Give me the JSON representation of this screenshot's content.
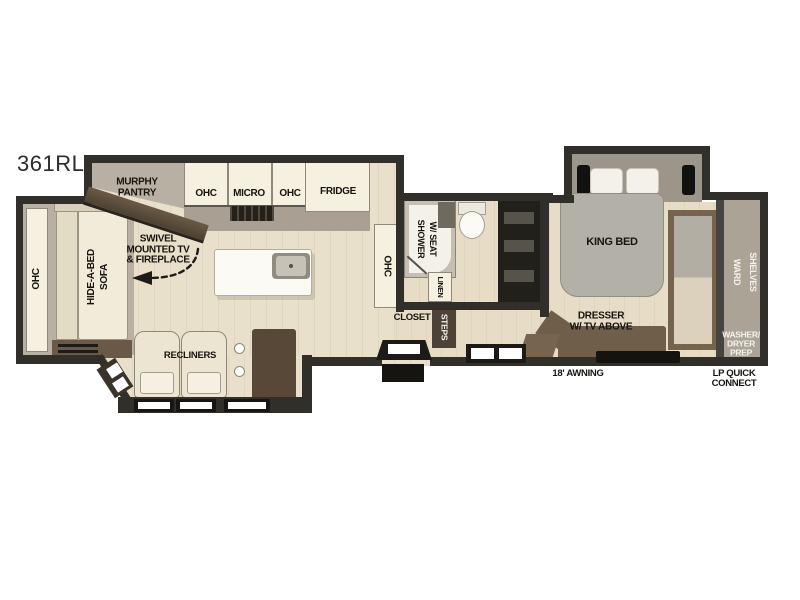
{
  "model": "361RL",
  "palette": {
    "wall": "#312f2a",
    "floor_main": "#e9e0cb",
    "floor_bed_bath": "#e7dcc5",
    "slide_floor": "#b8b0a2",
    "closet_floor": "#aba395",
    "cabinet_white": "#f6f0e0",
    "counter_gray": "#a9a093",
    "furniture_brown": "#6f5e4a",
    "dark_brown": "#4c4336",
    "sofa_cream": "#f1ebd9",
    "bed_gray": "#b3b0a7",
    "vanity_black": "#21201b",
    "window_black": "#1b1a17"
  },
  "labels": {
    "murphy_pantry": [
      "MURPHY",
      "PANTRY"
    ],
    "kitchen": {
      "ohc_left": "OHC",
      "micro": "MICRO",
      "ohc_right": "OHC",
      "fridge": "FRIDGE"
    },
    "swivel_tv": [
      "SWIVEL",
      "MOUNTED TV",
      "& FIREPLACE"
    ],
    "ohc_side": "OHC",
    "hide_a_bed": [
      "HIDE-A-BED",
      "SOFA"
    ],
    "recliners": "RECLINERS",
    "ohc_mid": "OHC",
    "shower": [
      "SHOWER",
      "W/ SEAT"
    ],
    "linen": "LINEN",
    "closet": "CLOSET",
    "steps": "STEPS",
    "king_bed": "KING BED",
    "dresser": [
      "DRESSER",
      "W/ TV ABOVE"
    ],
    "ward": "WARD",
    "shelves": "SHELVES",
    "washer_dryer": [
      "WASHER/",
      "DRYER",
      "PREP"
    ],
    "awning": "18' AWNING",
    "lp_quick": [
      "LP QUICK",
      "CONNECT"
    ]
  }
}
